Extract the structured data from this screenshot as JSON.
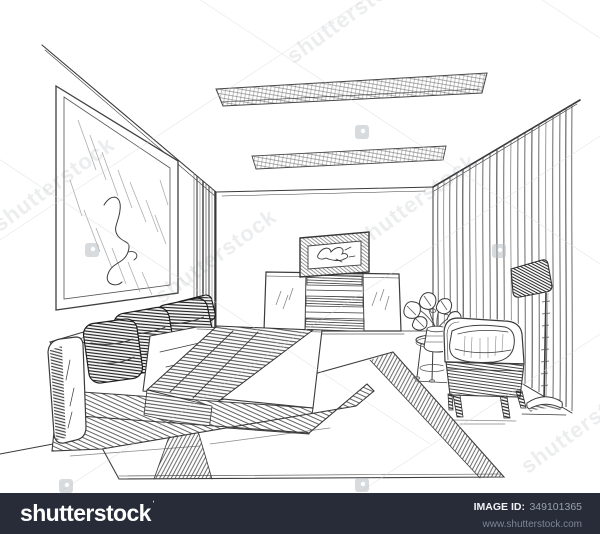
{
  "page": {
    "width": 600,
    "height": 534,
    "background": "#ffffff"
  },
  "artwork": {
    "kind": "pencil-sketch-bedroom-interior",
    "objects": [
      "wall-picture",
      "ceiling-lamp-far",
      "ceiling-lamp-near",
      "corner-curtain-strip",
      "dresser",
      "tv",
      "window-curtains",
      "floor-lamp",
      "armchair",
      "seat-cushion",
      "side-table",
      "plant-vase",
      "platform-bed",
      "pillows",
      "blanket",
      "rug"
    ]
  },
  "watermark": {
    "text": "shutterstock",
    "icon": "shutterstock-badge-icon",
    "color": "#70757d"
  },
  "footer": {
    "background": "#272c38",
    "logo": "shutterstock",
    "logo_mark": "ˈ",
    "image_id_label": "IMAGE ID:",
    "image_id": "349101365",
    "website": "www.shutterstock.com"
  }
}
